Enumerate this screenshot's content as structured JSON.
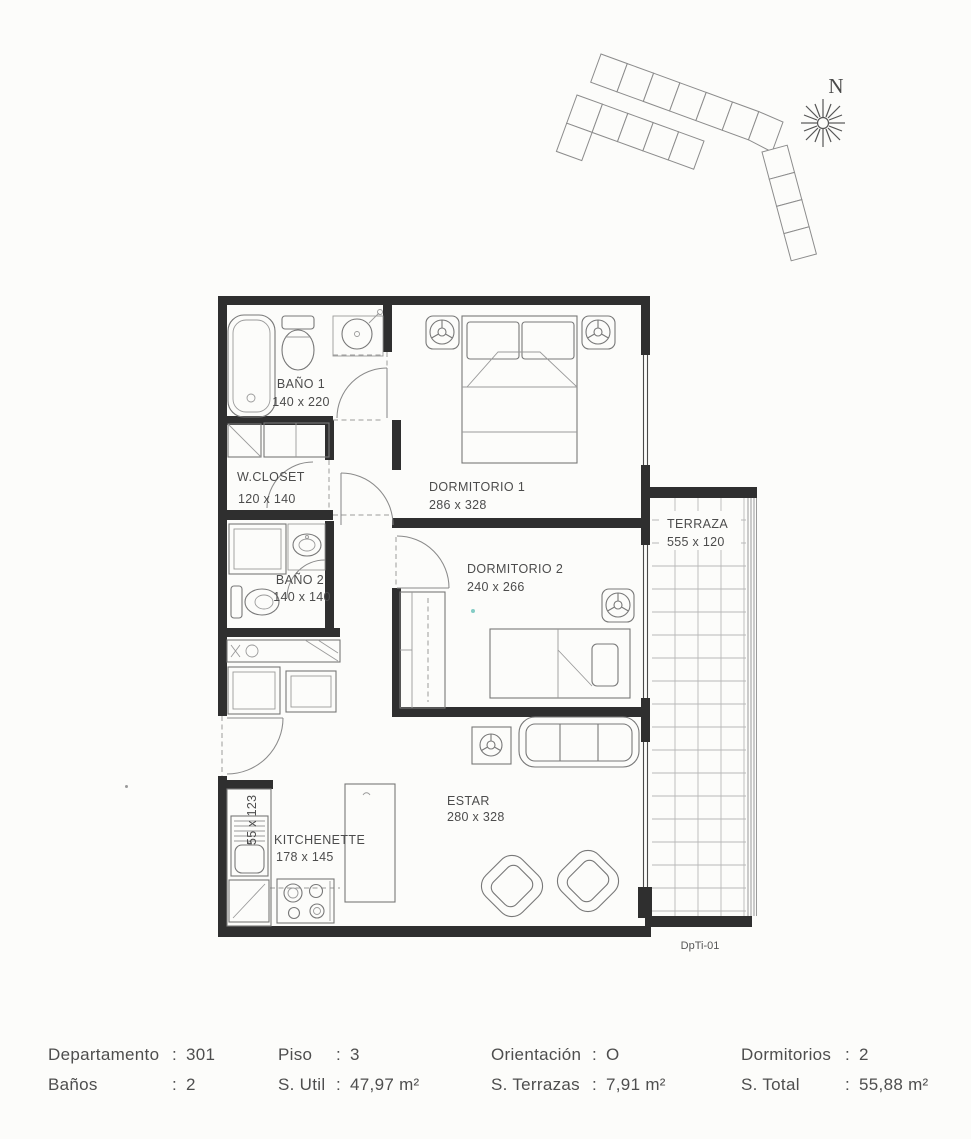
{
  "site_plan": {
    "compass_label": "N"
  },
  "floor_plan": {
    "code": "DpTi-01",
    "rooms": {
      "bano1": {
        "name": "BAÑO 1",
        "dims": "140 x 220"
      },
      "wcloset": {
        "name": "W.CLOSET",
        "dims": "120 x 140"
      },
      "bano2": {
        "name": "BAÑO 2",
        "dims": "140 x 140"
      },
      "dorm1": {
        "name": "DORMITORIO 1",
        "dims": "286 x 328"
      },
      "dorm2": {
        "name": "DORMITORIO 2",
        "dims": "240 x 266"
      },
      "terraza": {
        "name": "TERRAZA",
        "dims": "555 x 120"
      },
      "estar": {
        "name": "ESTAR",
        "dims": "280 x 328"
      },
      "kitchenette": {
        "name": "KITCHENETTE",
        "dims": "178 x 145"
      },
      "kitchen_sink": {
        "dims": "55 x 123"
      }
    }
  },
  "info": {
    "columns": [
      {
        "rows": [
          {
            "label": "Departamento",
            "value": "301"
          },
          {
            "label": "Baños",
            "value": "2"
          }
        ]
      },
      {
        "rows": [
          {
            "label": "Piso",
            "value": "3"
          },
          {
            "label": "S. Util",
            "value": "47,97 m²"
          }
        ]
      },
      {
        "rows": [
          {
            "label": "Orientación",
            "value": "O"
          },
          {
            "label": "S. Terrazas",
            "value": "7,91 m²"
          }
        ]
      },
      {
        "rows": [
          {
            "label": "Dormitorios",
            "value": "2"
          },
          {
            "label": "S. Total",
            "value": "55,88 m²"
          }
        ]
      }
    ]
  }
}
